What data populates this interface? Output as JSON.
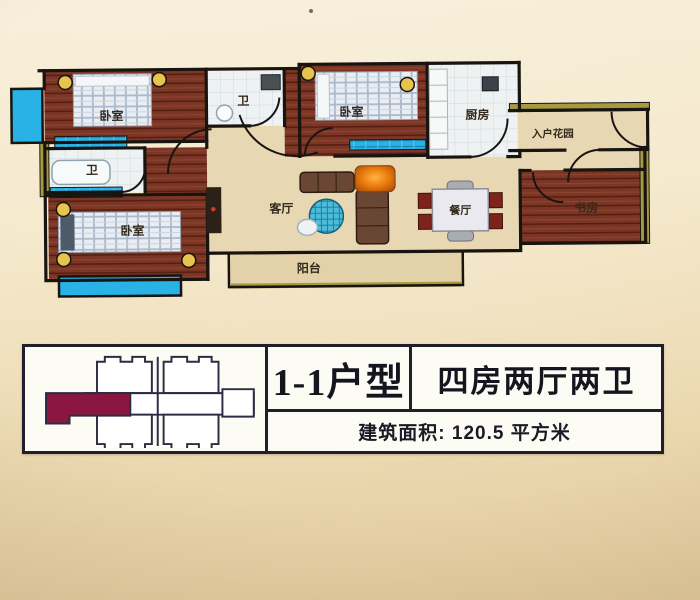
{
  "floorplan": {
    "rooms": {
      "bedroom_top_left": "卧室",
      "bath_top": "卫",
      "bedroom_top_mid": "卧室",
      "kitchen": "厨房",
      "entry_garden": "入户花园",
      "bath_left": "卫",
      "bedroom_bottom_left": "卧室",
      "living_room": "客厅",
      "dining_room": "餐厅",
      "study": "书房",
      "balcony": "阳台"
    }
  },
  "info_table": {
    "unit_type": "1-1户型",
    "layout": "四房两厅两卫",
    "area_label": "建筑面积: 120.5 平方米"
  },
  "colors": {
    "wood_floor": "#7b3625",
    "hall_floor": "#e8d7b3",
    "window_cyan": "#29b2e6",
    "wall_accent_olive": "#a69b40",
    "highlight_unit_maroon": "#8b1640",
    "accent_orange": "#ef8412"
  }
}
